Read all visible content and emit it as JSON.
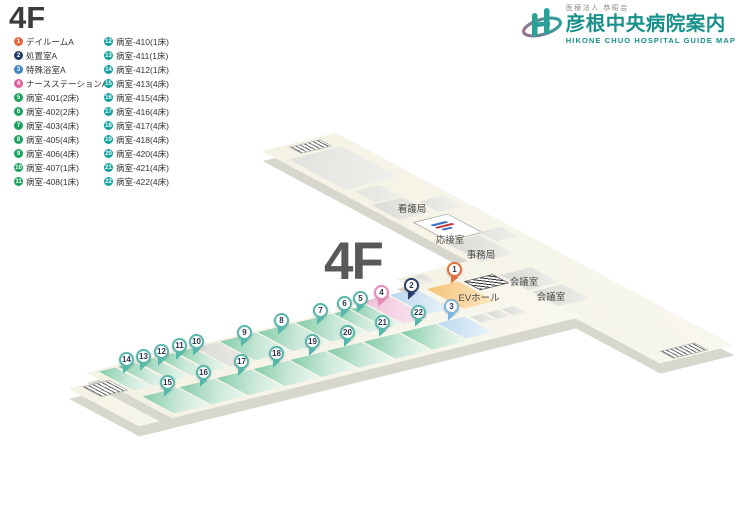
{
  "page": {
    "floor_title": "4F",
    "floor_watermark": "4F"
  },
  "logo": {
    "corporate": "医療法人 恭昭会",
    "hospital_name": "彦根中央病院案内",
    "english": "HIKONE CHUO HOSPITAL GUIDE MAP",
    "accent_color": "#17918a"
  },
  "legend": {
    "columns": [
      {
        "items": [
          {
            "num": 1,
            "label": "デイルームA",
            "color": "#e4673d"
          },
          {
            "num": 2,
            "label": "処置室A",
            "color": "#223a66"
          },
          {
            "num": 3,
            "label": "特殊浴室A",
            "color": "#4484c2"
          },
          {
            "num": 4,
            "label": "ナースステーションA",
            "color": "#e0619b"
          },
          {
            "num": 5,
            "label": "病室-401(2床)",
            "color": "#1ea15e"
          },
          {
            "num": 6,
            "label": "病室-402(2床)",
            "color": "#1ea15e"
          },
          {
            "num": 7,
            "label": "病室-403(4床)",
            "color": "#1ea15e"
          },
          {
            "num": 8,
            "label": "病室-405(4床)",
            "color": "#1ea15e"
          },
          {
            "num": 9,
            "label": "病室-406(4床)",
            "color": "#1ea15e"
          },
          {
            "num": 10,
            "label": "病室-407(1床)",
            "color": "#1ea15e"
          },
          {
            "num": 11,
            "label": "病室-408(1床)",
            "color": "#1ea15e"
          }
        ]
      },
      {
        "items": [
          {
            "num": 12,
            "label": "病室-410(1床)",
            "color": "#12a1a1"
          },
          {
            "num": 13,
            "label": "病室-411(1床)",
            "color": "#12a1a1"
          },
          {
            "num": 14,
            "label": "病室-412(1床)",
            "color": "#12a1a1"
          },
          {
            "num": 15,
            "label": "病室-413(4床)",
            "color": "#12a1a1"
          },
          {
            "num": 16,
            "label": "病室-415(4床)",
            "color": "#12a1a1"
          },
          {
            "num": 17,
            "label": "病室-416(4床)",
            "color": "#12a1a1"
          },
          {
            "num": 18,
            "label": "病室-417(4床)",
            "color": "#12a1a1"
          },
          {
            "num": 19,
            "label": "病室-418(4床)",
            "color": "#12a1a1"
          },
          {
            "num": 20,
            "label": "病室-420(4床)",
            "color": "#12a1a1"
          },
          {
            "num": 21,
            "label": "病室-421(4床)",
            "color": "#12a1a1"
          },
          {
            "num": 22,
            "label": "病室-422(4床)",
            "color": "#12a1a1"
          }
        ]
      }
    ]
  },
  "map": {
    "labels": [
      {
        "text": "看護局",
        "x": 412,
        "y": 208
      },
      {
        "text": "応接室",
        "x": 450,
        "y": 239
      },
      {
        "text": "事務局",
        "x": 481,
        "y": 254
      },
      {
        "text": "会議室",
        "x": 524,
        "y": 281
      },
      {
        "text": "会議室",
        "x": 551,
        "y": 296
      },
      {
        "text": "EVホール",
        "x": 479,
        "y": 297
      }
    ],
    "pins": [
      {
        "num": 1,
        "x": 455,
        "y": 270,
        "color": "#e2703f"
      },
      {
        "num": 2,
        "x": 412,
        "y": 286,
        "color": "#2b4068"
      },
      {
        "num": 3,
        "x": 452,
        "y": 307,
        "color": "#7fb6dc"
      },
      {
        "num": 4,
        "x": 382,
        "y": 293,
        "color": "#e98ab8"
      },
      {
        "num": 5,
        "x": 361,
        "y": 299,
        "color": "#55b8ab"
      },
      {
        "num": 6,
        "x": 345,
        "y": 304,
        "color": "#55b8ab"
      },
      {
        "num": 7,
        "x": 321,
        "y": 311,
        "color": "#55b8ab"
      },
      {
        "num": 8,
        "x": 282,
        "y": 321,
        "color": "#55b8ab"
      },
      {
        "num": 9,
        "x": 245,
        "y": 333,
        "color": "#55b8ab"
      },
      {
        "num": 10,
        "x": 197,
        "y": 342,
        "color": "#55b8ab"
      },
      {
        "num": 11,
        "x": 180,
        "y": 346,
        "color": "#55b8ab"
      },
      {
        "num": 12,
        "x": 162,
        "y": 352,
        "color": "#55b8ab"
      },
      {
        "num": 13,
        "x": 144,
        "y": 357,
        "color": "#55b8ab"
      },
      {
        "num": 14,
        "x": 127,
        "y": 360,
        "color": "#55b8ab"
      },
      {
        "num": 15,
        "x": 168,
        "y": 383,
        "color": "#55b8ab"
      },
      {
        "num": 16,
        "x": 204,
        "y": 373,
        "color": "#55b8ab"
      },
      {
        "num": 17,
        "x": 242,
        "y": 362,
        "color": "#55b8ab"
      },
      {
        "num": 18,
        "x": 277,
        "y": 354,
        "color": "#55b8ab"
      },
      {
        "num": 19,
        "x": 313,
        "y": 342,
        "color": "#55b8ab"
      },
      {
        "num": 20,
        "x": 348,
        "y": 333,
        "color": "#55b8ab"
      },
      {
        "num": 21,
        "x": 383,
        "y": 323,
        "color": "#55b8ab"
      },
      {
        "num": 22,
        "x": 419,
        "y": 313,
        "color": "#55b8ab"
      }
    ]
  }
}
